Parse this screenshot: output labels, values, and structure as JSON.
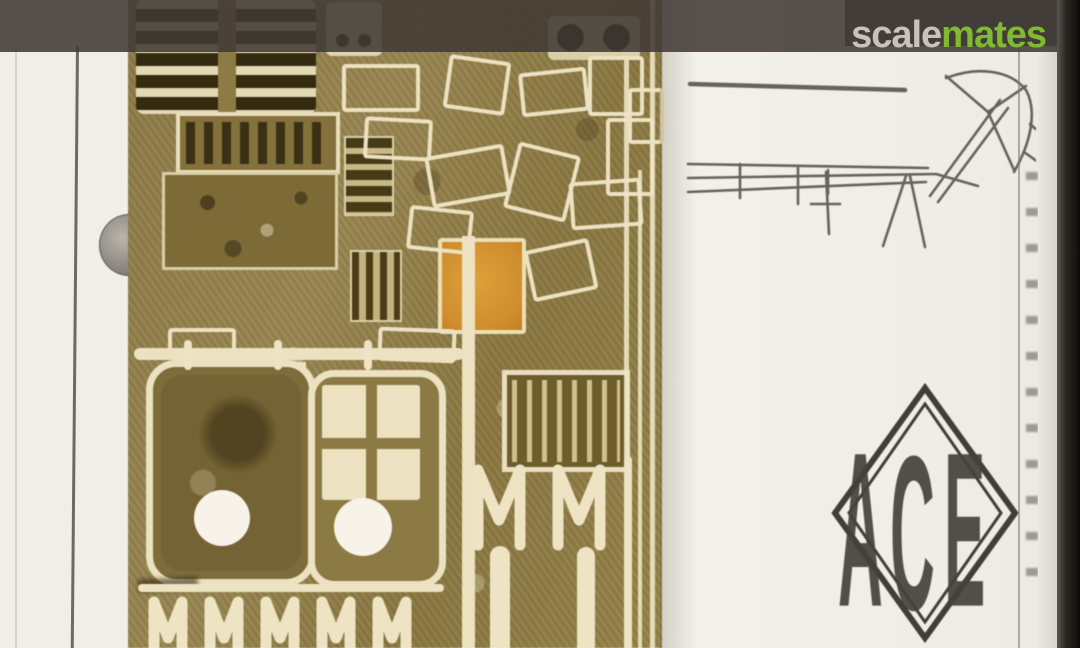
{
  "watermark": {
    "part1": "scale",
    "part2": "mates"
  },
  "brand": {
    "name": "ACE",
    "letters": {
      "a": "A",
      "c": "C",
      "e": "E"
    }
  },
  "palette": {
    "paper": "#f2f1ec",
    "paper-left": "#efeee9",
    "band": "rgba(64,58,53,0.87)",
    "brass": "#8e7c46",
    "etch": "#ece2c2",
    "slot": "#332a10",
    "orange": "#d08e2e",
    "sketch-ink": "#4e4b46",
    "wm-gray": "#c6c3bf",
    "wm-green": "#80ba30"
  }
}
